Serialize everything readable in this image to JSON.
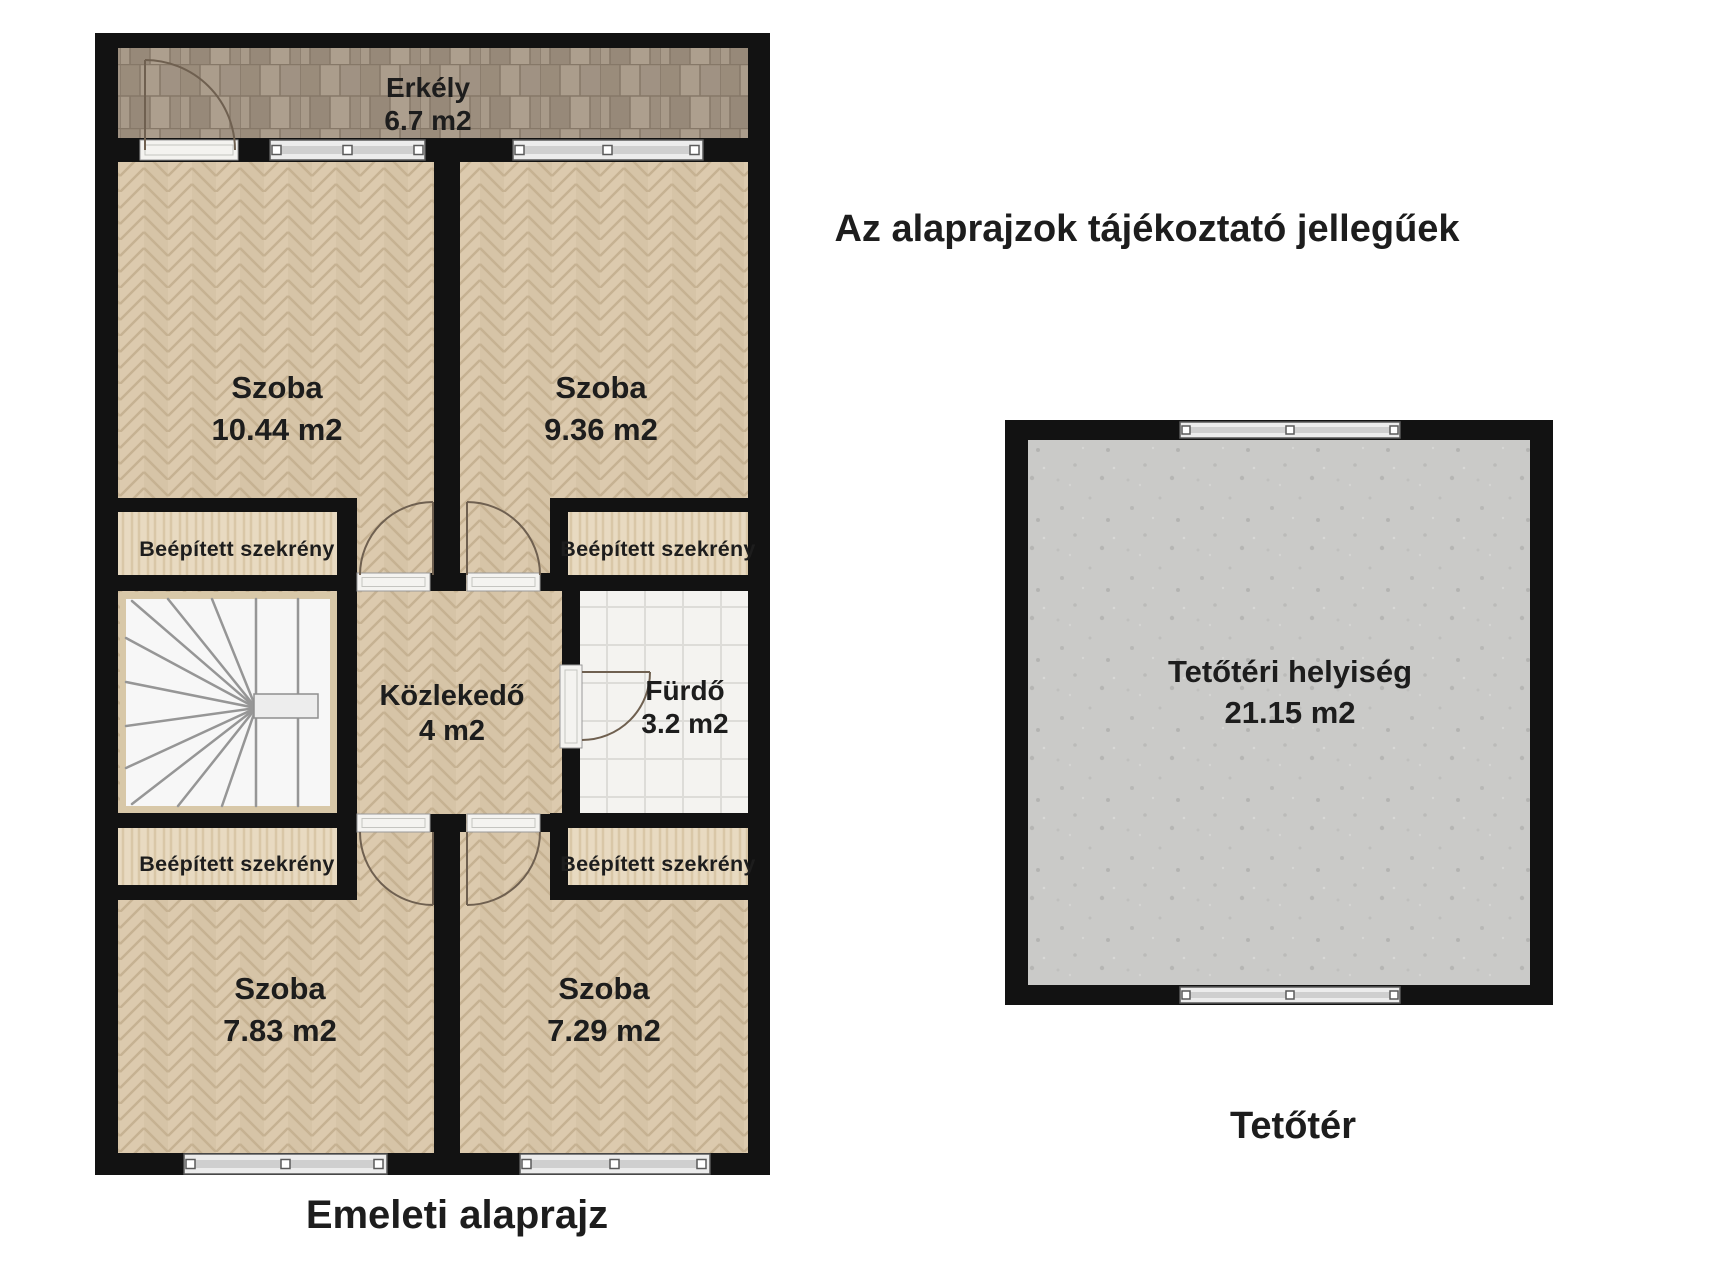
{
  "disclaimer": "Az alaprajzok tájékoztató jellegűek",
  "upper_floor": {
    "caption": "Emeleti alaprajz",
    "balcony": {
      "name": "Erkély",
      "area": "6.7 m2"
    },
    "room_top_left": {
      "name": "Szoba",
      "area": "10.44 m2"
    },
    "room_top_right": {
      "name": "Szoba",
      "area": "9.36 m2"
    },
    "closet_top_left": {
      "name": "Beépített szekrény"
    },
    "closet_top_right": {
      "name": "Beépített szekrény"
    },
    "hallway": {
      "name": "Közlekedő",
      "area": "4 m2"
    },
    "bathroom": {
      "name": "Fürdő",
      "area": "3.2 m2"
    },
    "closet_bottom_left": {
      "name": "Beépített szekrény"
    },
    "closet_bottom_right": {
      "name": "Beépített szekrény"
    },
    "room_bottom_left": {
      "name": "Szoba",
      "area": "7.83 m2"
    },
    "room_bottom_right": {
      "name": "Szoba",
      "area": "7.29 m2"
    }
  },
  "attic": {
    "caption": "Tetőtér",
    "room": {
      "name": "Tetőtéri helyiség",
      "area": "21.15 m2"
    }
  },
  "colors": {
    "wall": "#121212",
    "parquet": "#d8c6aa",
    "balcony_deck": "#a39584",
    "closet_wood": "#e8dac1",
    "bathroom_tile": "#f4f3f0",
    "attic_concrete": "#cacac8",
    "text": "#1d1d1d"
  }
}
